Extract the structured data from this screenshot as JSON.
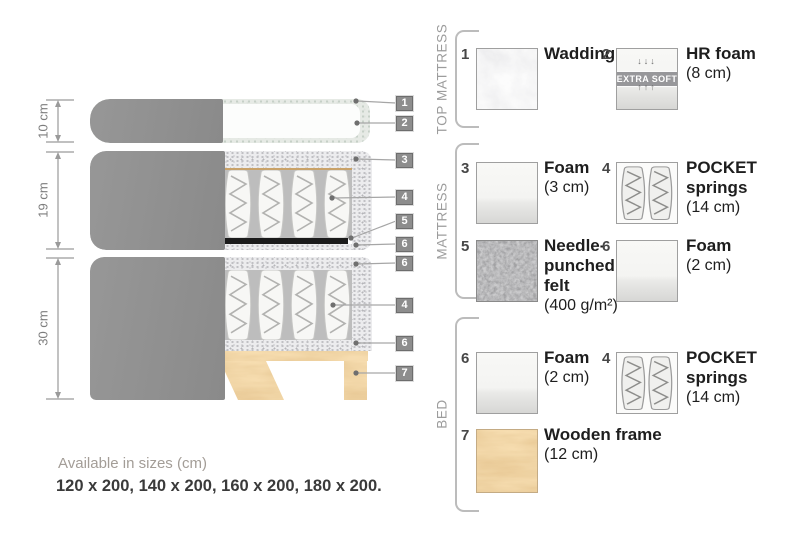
{
  "diagram": {
    "dimensions": [
      {
        "label": "10 cm"
      },
      {
        "label": "19 cm"
      },
      {
        "label": "30 cm"
      }
    ],
    "callouts": [
      "1",
      "2",
      "3",
      "4",
      "5",
      "6",
      "6",
      "4",
      "6",
      "7"
    ]
  },
  "legend": {
    "sections": [
      {
        "label": "TOP MATTRESS",
        "items": [
          {
            "num": "1",
            "title": "Wadding",
            "size": ""
          },
          {
            "num": "2",
            "title": "HR foam",
            "size": "(8 cm)",
            "soft_label": "EXTRA SOFT",
            "arrows_down": "↓↓↓",
            "arrows_up": "↑↑↑"
          }
        ]
      },
      {
        "label": "MATTRESS",
        "items": [
          {
            "num": "3",
            "title": "Foam",
            "size": "(3 cm)"
          },
          {
            "num": "4",
            "title": "POCKET\nsprings",
            "size": "(14 cm)"
          },
          {
            "num": "5",
            "title": "Needle-\npunched\nfelt",
            "size": "(400 g/m²)"
          },
          {
            "num": "6",
            "title": "Foam",
            "size": "(2 cm)"
          }
        ]
      },
      {
        "label": "BED",
        "items": [
          {
            "num": "6",
            "title": "Foam",
            "size": "(2 cm)"
          },
          {
            "num": "4",
            "title": "POCKET\nsprings",
            "size": "(14 cm)"
          },
          {
            "num": "7",
            "title": "Wooden frame",
            "size": "(12 cm)"
          }
        ]
      }
    ]
  },
  "footer": {
    "line1": "Available in sizes (cm)",
    "line2": "120 x 200, 140 x 200, 160 x 200, 180 x 200."
  },
  "colors": {
    "fabric_gray": "#8f8f8f",
    "badge_gray": "#8d8d8d",
    "wood_tan": "#e2ae62",
    "felt_dark": "#4a4a4a",
    "text_dark": "#1e1e1e",
    "muted_gray": "#9c9c9c"
  }
}
